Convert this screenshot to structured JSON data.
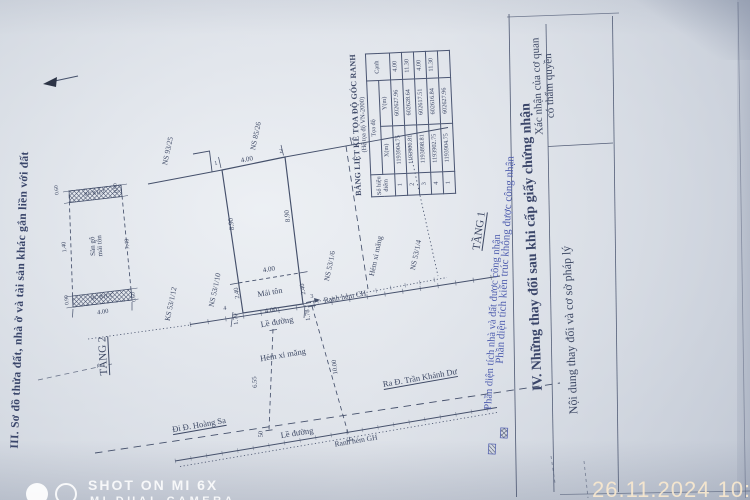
{
  "photo": {
    "watermark": {
      "line1": "SHOT ON MI 6X",
      "line2": "MI DUAL CAMERA"
    },
    "timestamp": "26.11.2024 10:35"
  },
  "section3": {
    "caption": "III. Sơ đồ thửa đất, nhà ở và tài sản khác gắn liền với đất",
    "floor2": {
      "label": "TẦNG 2",
      "balcony_top": "BC BTCT",
      "balcony_bottom": "BC BTCT",
      "interior_line1": "Sàn gỗ",
      "interior_line2": "mái tôn",
      "dim_width": "4.00",
      "dim_left": "1.40",
      "dim_right": "7.40",
      "dim_top_left": "0.60",
      "dim_top_right": "0.90",
      "dim_bottom_left": "0.90",
      "dim_bottom_right": "0.60"
    },
    "floor1_label": "TẦNG 1",
    "plot": {
      "dim_top": "4.00",
      "dim_left": "8.90",
      "dim_right": "8.90",
      "roof_label": "Mái tôn",
      "dim_roof": "4.00",
      "dim_roof_left": "2.40",
      "dim_roof_right": "2.40",
      "dim_bottom": "4.00",
      "p1": "1",
      "p2": "2",
      "p3": "3",
      "p4": "4"
    },
    "neighbors": {
      "nw": "NS 93/25",
      "ne": "NS 85/26",
      "w": "NS 53/1/10",
      "sw": "KS 53/1/12",
      "e1": "NS 53/1/6",
      "alley": "Hẻm xi măng",
      "e2": "NS 53/1/4"
    },
    "road": {
      "ranh_hem_upper": "Ranh hẻm CH",
      "le_duong_upper": "Lề đường",
      "dim_170": "1.70",
      "dim_178": "1.78",
      "hem_xi_mang": "Hẻm xi măng",
      "dim_655": "6.55",
      "dim_1000": "10.00",
      "dim_50": "50",
      "di_hoang_sa": "Đi Đ. Hoàng Sa",
      "ra_tran_khanh_du": "Ra Đ. Trần Khánh Dư",
      "le_duong_lower": "Lề đường",
      "ranh_hem_lower": "Ranh hẻm GH"
    },
    "coord_table": {
      "title": "BẢNG LIỆT KÊ TỌA ĐỘ GÓC RANH",
      "subtitle": "(Hệ tọa độ VN-2000)",
      "col_point": "Số hiệu điểm",
      "col_coord": "Tọa độ",
      "col_x": "X(m)",
      "col_y": "Y(m)",
      "col_edge": "Cạnh",
      "rows": [
        [
          "1",
          "1193904.75",
          "602627.96",
          "4.00"
        ],
        [
          "2",
          "1193900.81",
          "602628.64",
          "11.30"
        ],
        [
          "3",
          "1193898.81",
          "602617.51",
          "4.00"
        ],
        [
          "4",
          "1193902.75",
          "602616.84",
          "11.30"
        ],
        [
          "1",
          "1193904.75",
          "602627.96",
          ""
        ]
      ]
    },
    "legend": {
      "item1": "Phần diện tích nhà và đất được công nhận",
      "item2": "Phần diện tích kiến trúc không được công nhận"
    }
  },
  "section4": {
    "title": "IV. Những thay đổi sau khi cấp giấy chứng nhận",
    "col_left": "Nội dung thay đổi và cơ sở pháp lý",
    "col_right_line1": "Xác nhận của cơ quan",
    "col_right_line2": "có thẩm quyền"
  }
}
